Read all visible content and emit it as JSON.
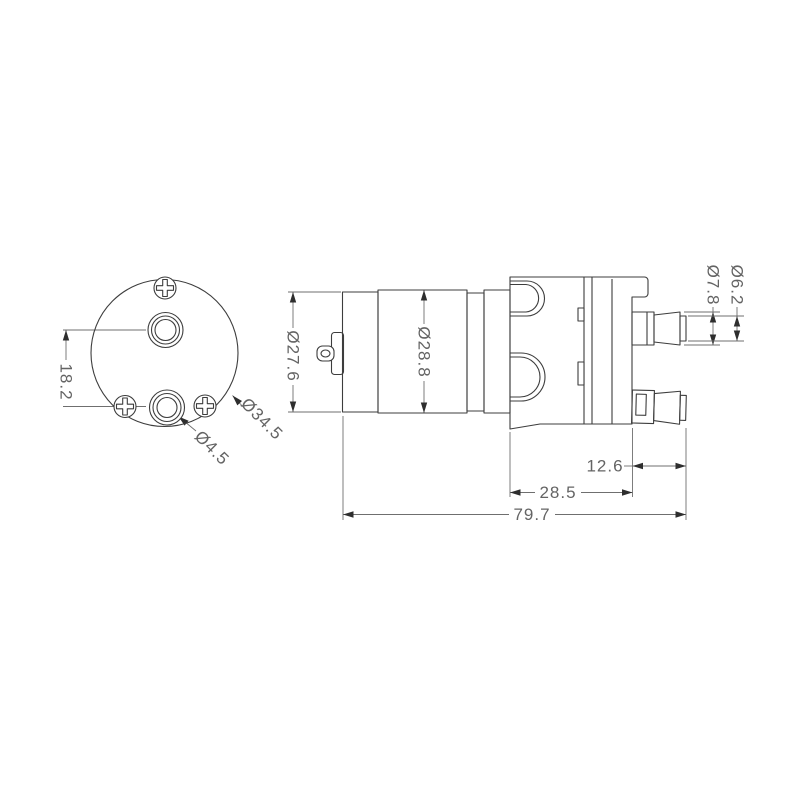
{
  "drawing": {
    "colors": {
      "bg": "#ffffff",
      "line": "#3d3d3d",
      "dim": "#6f6f6f",
      "text": "#646464",
      "arrow": "#2e2e2e"
    },
    "dimensions": {
      "port_spacing": "18.2",
      "flange_diameter": "Ø34.5",
      "port_hole_diameter": "Ø4.5",
      "rear_cap_diameter": "Ø27.6",
      "motor_body_diameter": "Ø28.8",
      "nozzle_barb_diameter": "Ø7.8",
      "nozzle_tip_diameter": "Ø6.2",
      "nozzle_length": "12.6",
      "pump_head_length": "28.5",
      "overall_length": "79.7"
    }
  }
}
